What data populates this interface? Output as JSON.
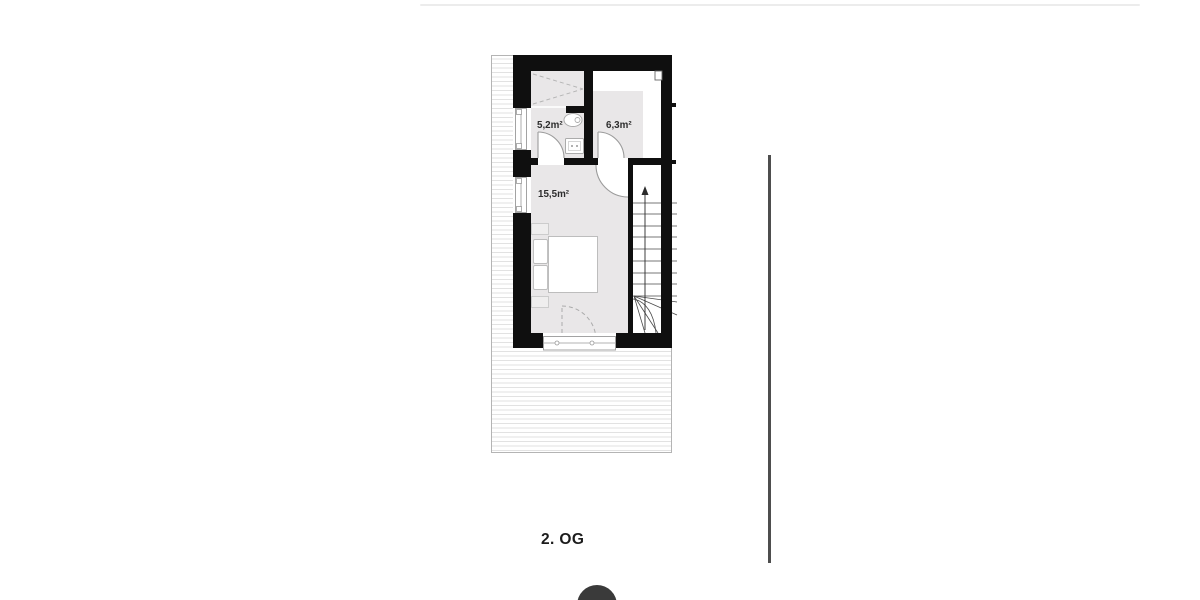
{
  "page": {
    "background_color": "#ffffff",
    "top_divider_color": "#ececec",
    "side_rule_color": "#4e4e4e"
  },
  "floorplan": {
    "title": "2. OG",
    "rooms": [
      {
        "name": "bathroom",
        "area_label": "5,2m²"
      },
      {
        "name": "small-room",
        "area_label": "6,3m²"
      },
      {
        "name": "bedroom",
        "area_label": "15,5m²"
      }
    ],
    "stairs": {
      "direction_label": "up"
    },
    "colors": {
      "wall": "#0f0f0f",
      "floor": "#e9e7e8",
      "hatch_line": "#e2e2e2",
      "hatch_border": "#b4b4b4",
      "door_stroke": "#9b9b9b",
      "furniture_stroke": "#bdbdbd",
      "stair_tread": "#4a4a4a"
    },
    "elements": [
      "shower",
      "toilet",
      "sink",
      "double-bed",
      "pillows",
      "nightstands",
      "staircase-up",
      "winder-steps",
      "left-windows",
      "bottom-window",
      "door-swings",
      "balcony-door-dashed",
      "roof-hatch"
    ]
  },
  "footer_button": {
    "color": "#3a3a3a"
  }
}
